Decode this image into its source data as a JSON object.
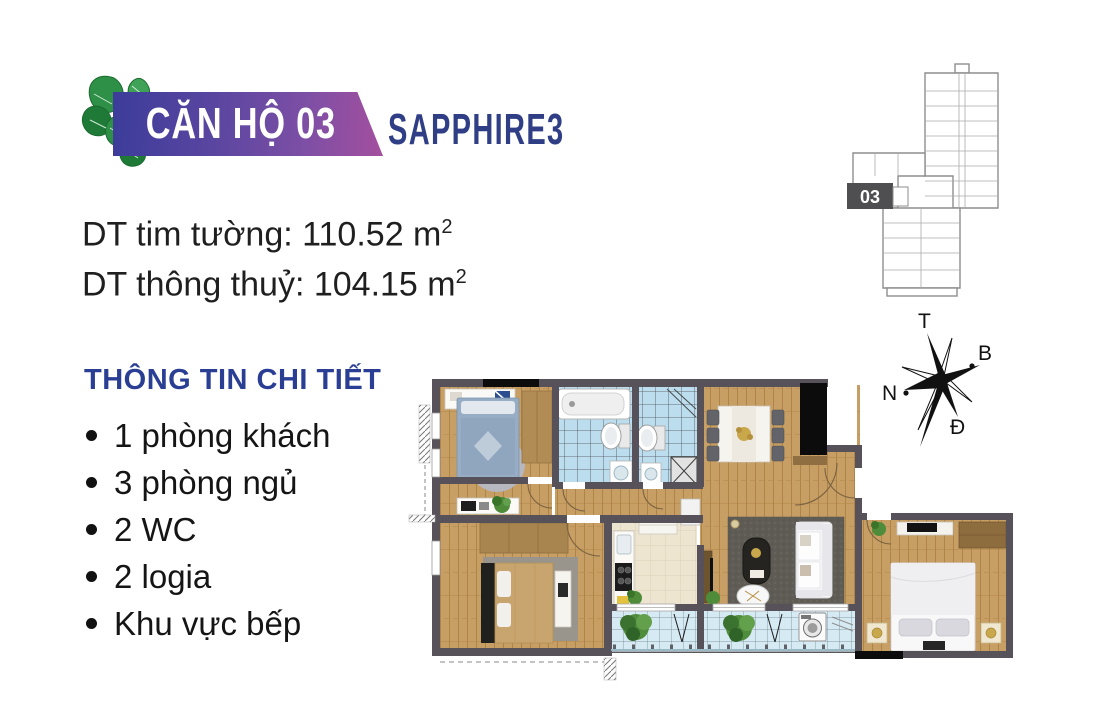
{
  "banner": {
    "unit_title": "CĂN HỘ 03",
    "project_name": "SAPPHIRE3"
  },
  "areas": {
    "gross": {
      "label": "DT tim tường: ",
      "value": "110.52 m",
      "sup": "2"
    },
    "net": {
      "label": "DT thông thuỷ: ",
      "value": "104.15 m",
      "sup": "2"
    }
  },
  "details": {
    "heading": "THÔNG TIN CHI TIẾT",
    "items": [
      "1 phòng khách",
      "3 phòng ngủ",
      "2 WC",
      "2 logia",
      "Khu vực bếp"
    ]
  },
  "site_map": {
    "unit_label": "03"
  },
  "compass": {
    "top": "T",
    "right": "B",
    "left": "N",
    "bottom": "Đ"
  },
  "colors": {
    "banner_gradient_start": "#3C3C9A",
    "banner_gradient_end": "#A44F9E",
    "project_blue": "#2F3E85",
    "heading_blue": "#2A3F94",
    "wall_gray": "#57525A",
    "wood_floor": "#C79E63",
    "wc_tile_blue": "#BCDDEE",
    "balcony_tile_blue": "#D6EAF3",
    "kitchen_cream": "#EDE5D0",
    "leaf_green": "#2E8F47"
  }
}
